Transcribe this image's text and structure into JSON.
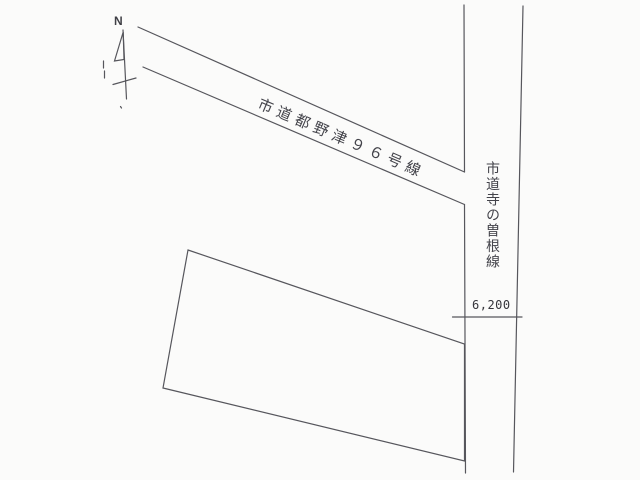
{
  "page": {
    "kind": "scanned cadastral road sketch map",
    "background_color": "#fbfbfa",
    "line_color": "#56565c",
    "text_color": "#3f3f45"
  },
  "compass": {
    "north_label": "N"
  },
  "roads": [
    {
      "id": "diagonal-road",
      "name": "市道都野津９６号線",
      "orientation": "diagonal-descending-right"
    },
    {
      "id": "vertical-road",
      "name": "市道寺の曽根線",
      "orientation": "vertical"
    }
  ],
  "dimensions": [
    {
      "id": "vertical-road-width",
      "value": "6,200"
    }
  ],
  "parcel": {
    "description": "unlabeled quadrilateral land parcel adjoining west side of vertical road"
  }
}
